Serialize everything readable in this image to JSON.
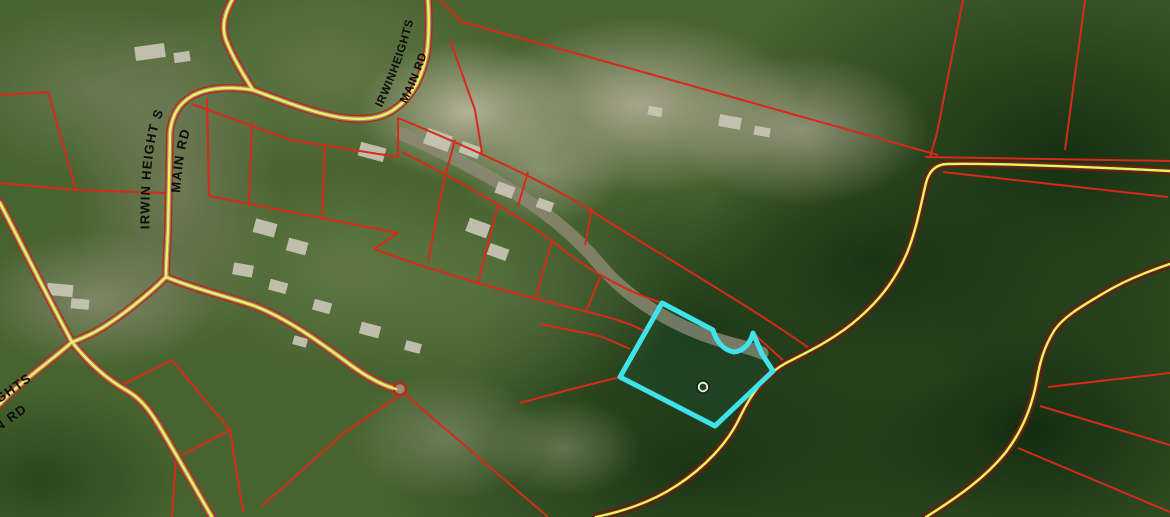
{
  "map": {
    "view": "satellite-cadastral-parcel-map",
    "labels": {
      "left_line1": "IRWIN HEIGHT S",
      "left_line2": "MAIN  RD",
      "top_line1": "IRWINHEIGHTS",
      "top_line2": "MAIN  RD",
      "bottom_left_line1": "EIGHTS",
      "bottom_left_line2": "AIN  RD"
    },
    "colors": {
      "parcel_boundary": "#d8291a",
      "road_centerline": "#f4f156",
      "road_casing_light": "#b62a1c",
      "road_surface_light": "#97907a",
      "road_casing_dark": "#6d1a0e",
      "road_surface_dark": "#473c2c",
      "selected_parcel": "#3fe3ec",
      "marker_ring": "#f2f2ee"
    },
    "selected_parcel": {
      "highlighted": true,
      "marker": "point-ring-marker"
    }
  }
}
